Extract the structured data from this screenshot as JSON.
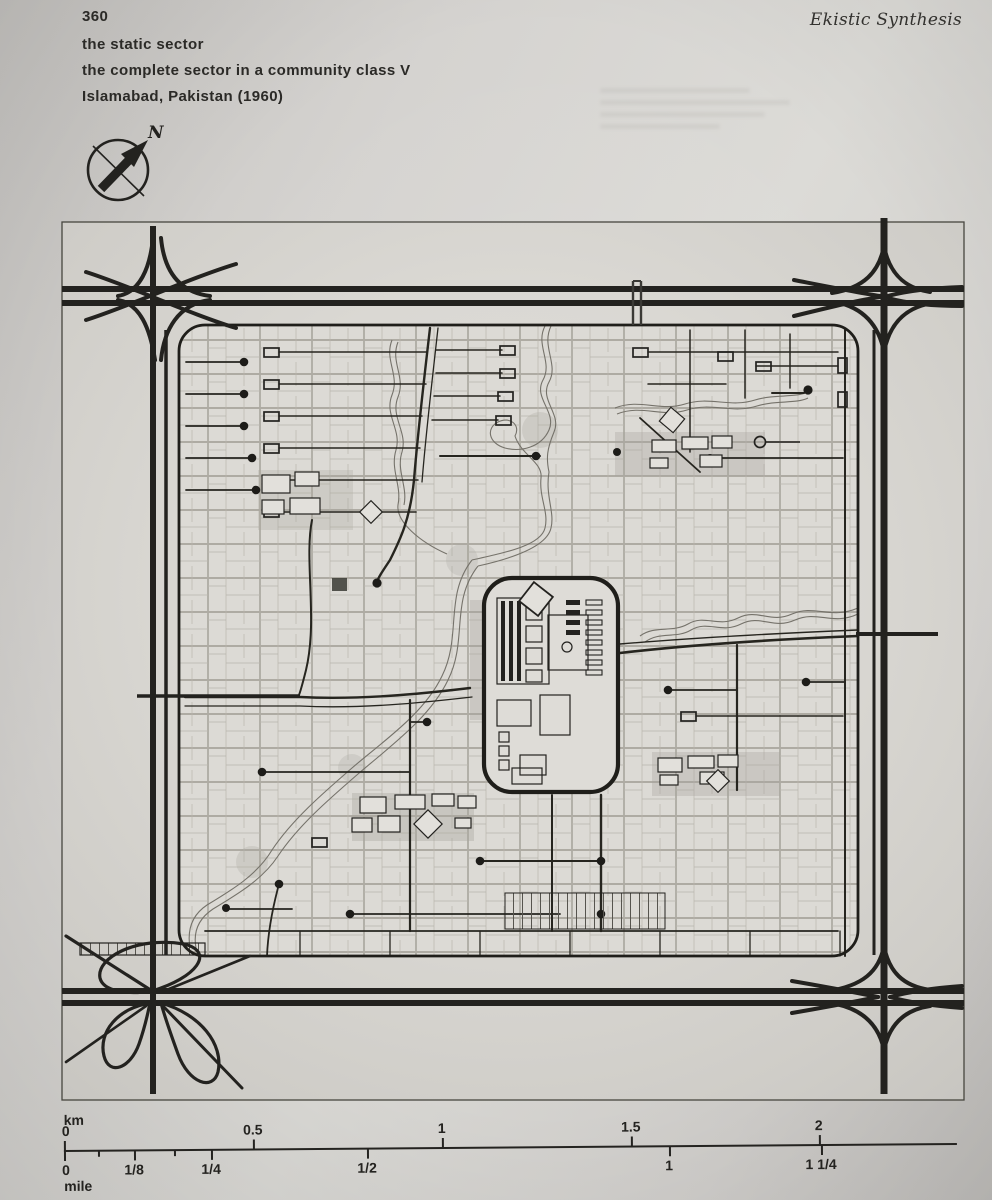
{
  "page": {
    "number": "360",
    "journal_title": "Ekistic Synthesis"
  },
  "captions": {
    "line1": "the static sector",
    "line2": "the complete sector in a community class V",
    "line3": "Islamabad, Pakistan (1960)"
  },
  "compass": {
    "label": "N"
  },
  "figure": {
    "description": "plan of one complete sector (community class V) of Islamabad, bounded by highways with corner interchanges, central civic spine, residential grid and stream greenways"
  },
  "scalebar": {
    "km_unit": "km",
    "mile_unit": "mile",
    "km_labels": [
      "0",
      "0.5",
      "1",
      "1.5",
      "2"
    ],
    "mile_labels": [
      "0",
      "1/8",
      "1/4",
      "1/2",
      "1",
      "1 1/4"
    ]
  },
  "colors": {
    "paper": "#d8d6d2",
    "ink": "#23221f",
    "faint_line": "#a6a39a",
    "stream": "#75726a"
  }
}
